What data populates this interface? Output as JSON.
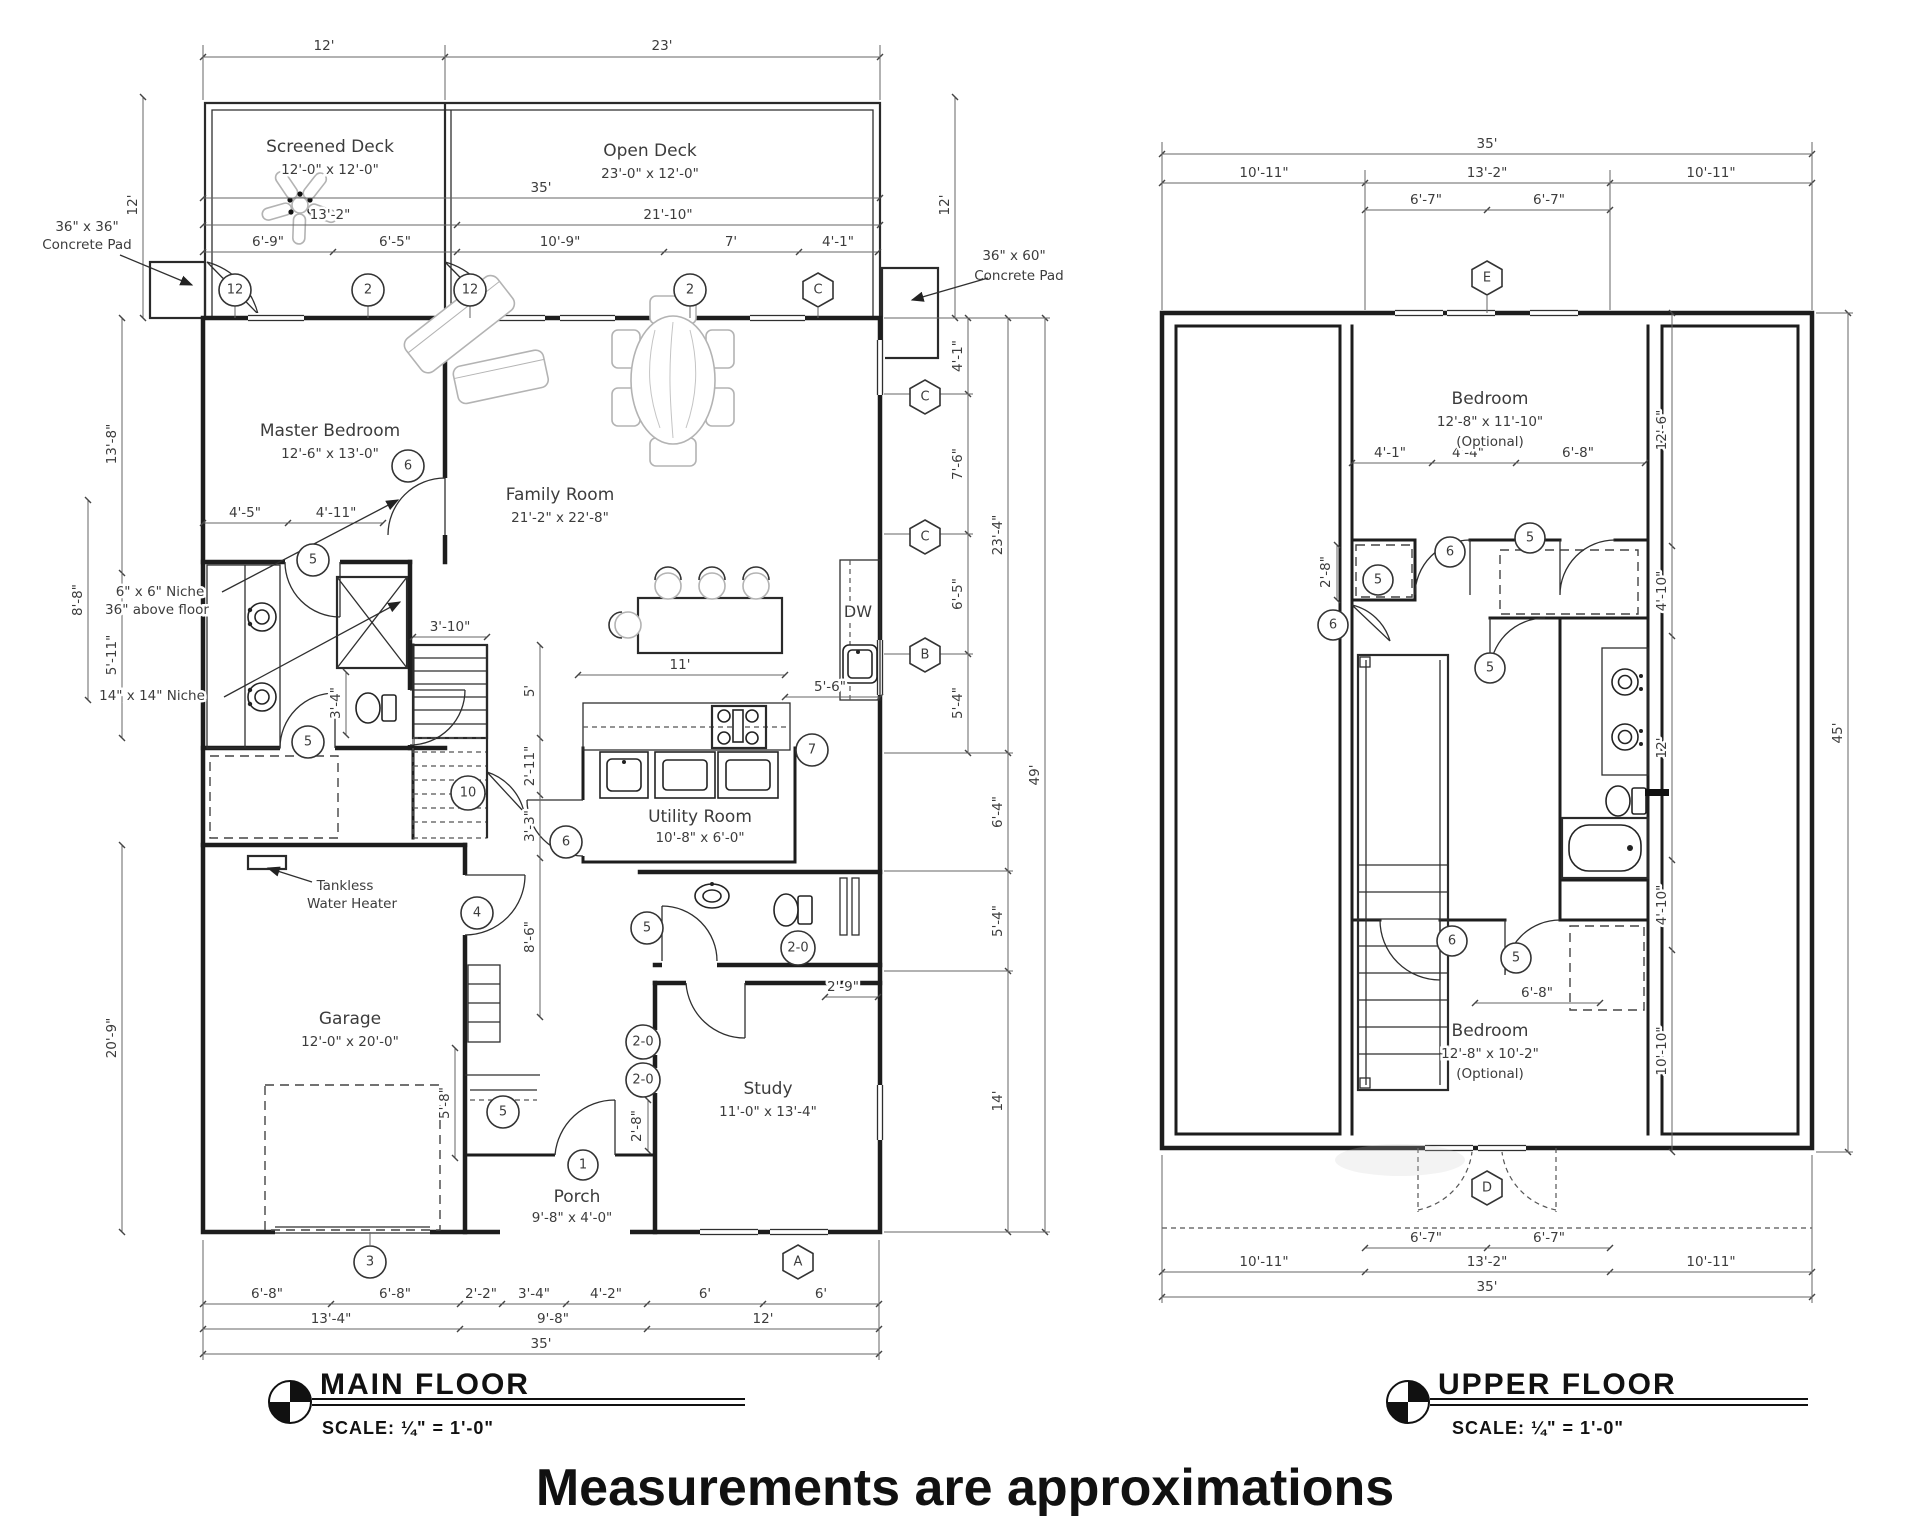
{
  "disclaimer": "Measurements are approximations",
  "main_floor": {
    "title": "Main Floor",
    "scale": "Scale: ¼\" = 1'-0\"",
    "rooms": {
      "screened_deck": {
        "name": "Screened Deck",
        "size": "12'-0\" x 12'-0\""
      },
      "open_deck": {
        "name": "Open Deck",
        "size": "23'-0\" x 12'-0\""
      },
      "master_bedroom": {
        "name": "Master Bedroom",
        "size": "12'-6\" x 13'-0\""
      },
      "family_room": {
        "name": "Family Room",
        "size": "21'-2\" x 22'-8\""
      },
      "utility_room": {
        "name": "Utility Room",
        "size": "10'-8\" x 6'-0\""
      },
      "garage": {
        "name": "Garage",
        "size": "12'-0\" x 20'-0\""
      },
      "study": {
        "name": "Study",
        "size": "11'-0\" x 13'-4\""
      },
      "porch": {
        "name": "Porch",
        "size": "9'-8\" x 4'-0\""
      }
    },
    "annotations": {
      "pad_left_1": "36\" x 36\"",
      "pad_left_2": "Concrete Pad",
      "pad_right_1": "36\" x 60\"",
      "pad_right_2": "Concrete Pad",
      "niche6_1": "6\" x 6\" Niche",
      "niche6_2": "36\" above floor",
      "niche14": "14\" x 14\" Niche",
      "tankless_1": "Tankless",
      "tankless_2": "Water Heater",
      "dw": "DW"
    },
    "dims": {
      "top": [
        "12'",
        "23'"
      ],
      "overall_width": "35'",
      "deck_row": [
        "13'-2\"",
        "21'-10\""
      ],
      "window_row": [
        "6'-9\"",
        "6'-5\"",
        "10'-9\"",
        "7'",
        "4'-1\""
      ],
      "pad_right_height": "12'",
      "left": [
        "12'",
        "13'-8\"",
        "8'-8\"",
        "5'-11\"",
        "20'-9\""
      ],
      "right_wall": [
        "4'-1\"",
        "7'-6\"",
        "6'-5\"",
        "5'-4\""
      ],
      "right_mid": [
        "23'-4\"",
        "6'-4\"",
        "5'-4\"",
        "14'"
      ],
      "right_overall": "49'",
      "master_row": [
        "4'-5\"",
        "4'-11\""
      ],
      "bath": [
        "3'-4\"",
        "3'-10\""
      ],
      "stair_col": [
        "5'",
        "2'-11\"",
        "3'-3\"",
        "8'-6\""
      ],
      "kitchen": [
        "11'",
        "5'-6\""
      ],
      "study_dims": [
        "2'-9\"",
        "2'-8\""
      ],
      "garage_side": "5'-8\"",
      "bottom1": [
        "6'-8\"",
        "6'-8\"",
        "2'-2\"",
        "3'-4\"",
        "4'-2\"",
        "6'",
        "6'"
      ],
      "bottom2": [
        "13'-4\"",
        "9'-8\"",
        "12'"
      ],
      "bottom3": "35'"
    },
    "callouts": {
      "circles": [
        "12",
        "2",
        "12",
        "2",
        "5",
        "6",
        "5",
        "10",
        "4",
        "6",
        "7",
        "5",
        "2-0",
        "2-0",
        "2-0",
        "5",
        "1",
        "3"
      ],
      "hexes": [
        "C",
        "C",
        "C",
        "B",
        "A"
      ]
    }
  },
  "upper_floor": {
    "title": "Upper Floor",
    "scale": "Scale: ¼\" = 1'-0\"",
    "rooms": {
      "bedroom_top": {
        "name": "Bedroom",
        "size": "12'-8\" x 11'-10\"",
        "note": "(Optional)"
      },
      "bedroom_bottom": {
        "name": "Bedroom",
        "size": "12'-8\" x 10'-2\"",
        "note": "(Optional)"
      }
    },
    "dims": {
      "top_overall": "35'",
      "top_row": [
        "10'-11\"",
        "13'-2\"",
        "10'-11\""
      ],
      "top_row2": [
        "6'-7\"",
        "6'-7\""
      ],
      "bedroom_row": [
        "4'-1\"",
        "4'-4\"",
        "6'-8\""
      ],
      "niche": "2'-8\"",
      "right_inner": [
        "12'-6\"",
        "4'-10\"",
        "12'",
        "4'-10\"",
        "10'-10\""
      ],
      "right_overall": "45'",
      "bed2_door": "6'-8\"",
      "bottom_row2": [
        "6'-7\"",
        "6'-7\""
      ],
      "bottom_row": [
        "10'-11\"",
        "13'-2\"",
        "10'-11\""
      ],
      "bottom_overall": "35'"
    },
    "callouts": {
      "circles": [
        "5",
        "6",
        "6",
        "5",
        "5",
        "6",
        "5"
      ],
      "hexes": [
        "E",
        "D"
      ]
    }
  }
}
